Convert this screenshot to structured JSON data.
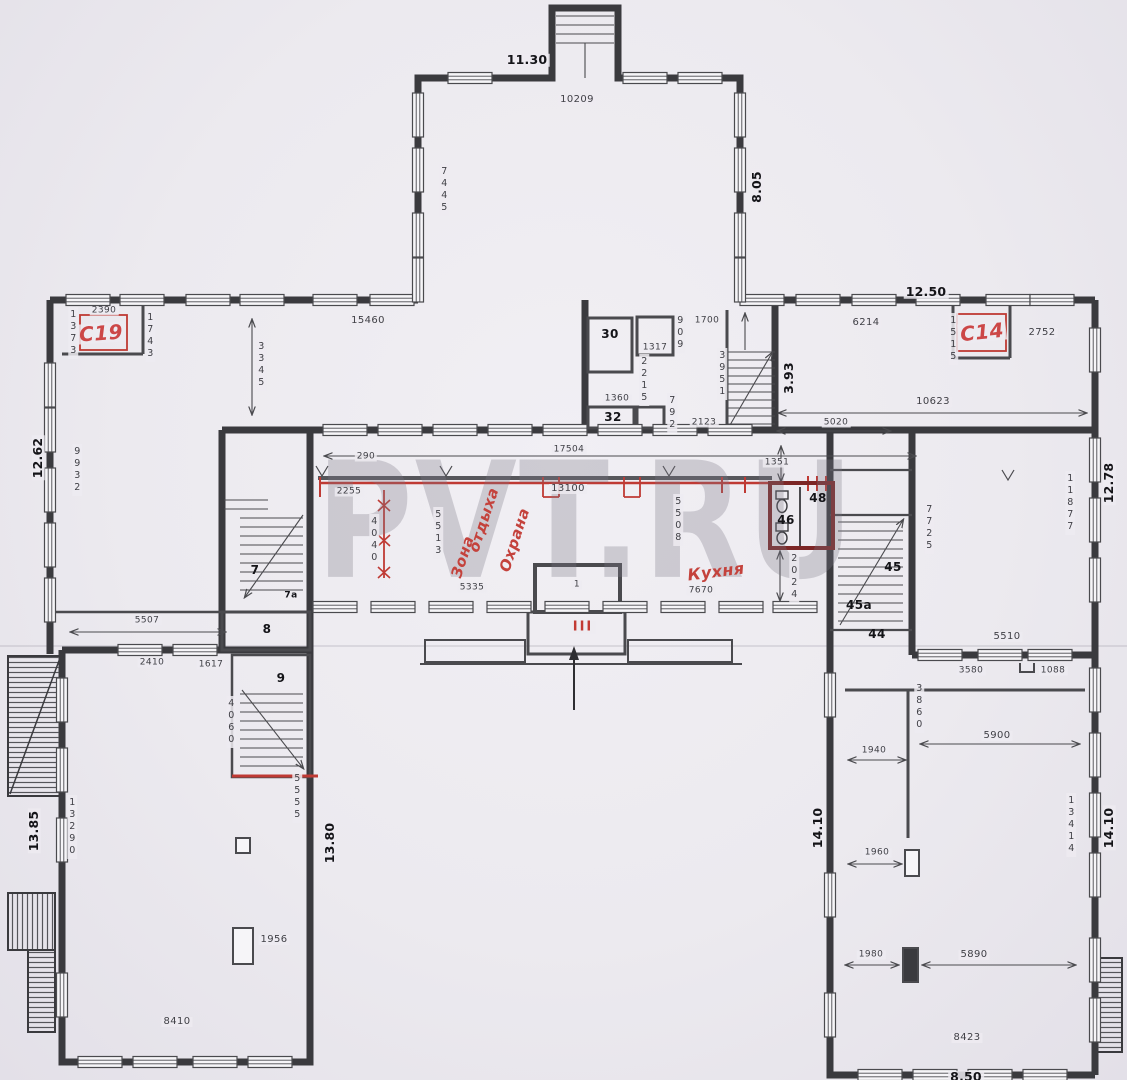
{
  "watermark": "PVT.RU",
  "labels": {
    "top_wing": {
      "w_outer": "11.30",
      "w_inner": "10209",
      "h_left": "7445",
      "h_right": "8.05"
    },
    "band": {
      "c19": "С19",
      "d2390": "2390",
      "d1373": "1373",
      "d1743": "1743",
      "d15460": "15460",
      "d3345": "3345",
      "d9932": "9932",
      "d1262": "12.62",
      "r30": "30",
      "d1317": "1317",
      "d909": "909",
      "d1700": "1700",
      "d2215": "2215",
      "d1360": "1360",
      "r32": "32",
      "d792": "792",
      "d2123": "2123",
      "d3951": "3951",
      "d393": "3.93",
      "d1250": "12.50",
      "d6214": "6214",
      "d1515": "1515",
      "c14": "С14",
      "d2752": "2752",
      "d10623": "10623",
      "d5020": "5020"
    },
    "hall": {
      "d17504": "17504",
      "d13100": "13100",
      "d290": "290",
      "d2255": "2255",
      "d5513": "5513",
      "d4040": "4040",
      "zona1": "Зона",
      "zona2": "отдыха",
      "ohrana": "Охрана",
      "kuhnya": "Кухня",
      "d5335": "5335",
      "d5508": "5508",
      "d7670": "7670",
      "d1351": "1351",
      "r46": "46",
      "r48": "48",
      "d2024": "2024",
      "r45": "45",
      "r45a": "45а",
      "r44": "44",
      "d7725": "7725",
      "r7": "7",
      "r7a": "7а",
      "r8": "8",
      "r1": "1",
      "entrance_mark": "III"
    },
    "left_wing": {
      "d5507": "5507",
      "d2410": "2410",
      "d1617": "1617",
      "r9": "9",
      "d4060": "4060",
      "d13290": "13290",
      "d1385": "13.85",
      "d5555": "5555",
      "d1380": "13.80",
      "d1956": "1956",
      "d8410": "8410"
    },
    "right_wing": {
      "d5510": "5510",
      "d3580": "3580",
      "d1088": "1088",
      "d3860": "3860",
      "d5900": "5900",
      "d1940": "1940",
      "d1960": "1960",
      "d1980": "1980",
      "d5890": "5890",
      "d8423": "8423",
      "d850": "8.50",
      "d13414": "13414",
      "d1410_left": "14.10",
      "d1410_right": "14.10",
      "d1278": "12.78",
      "d11877": "11877"
    }
  },
  "colors": {
    "red_annotation": "#c4423c",
    "dark_red_wall": "#7c2626",
    "wall": "#3a3a3e",
    "paper": "#eceaef"
  }
}
